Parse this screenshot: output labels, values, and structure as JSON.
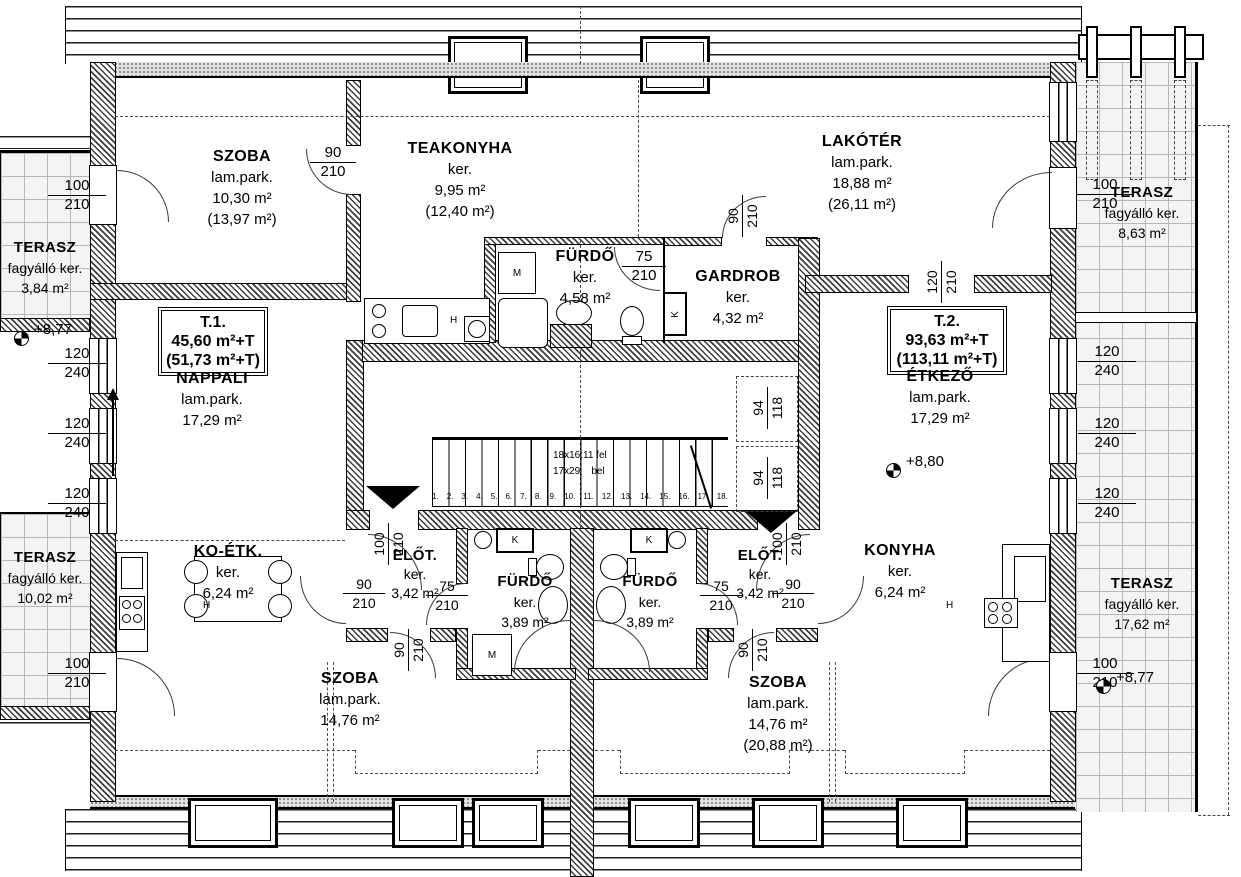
{
  "apartments": {
    "t1": {
      "id": "T.1.",
      "line2": "45,60 m²+T",
      "line3": "(51,73 m²+T)"
    },
    "t2": {
      "id": "T.2.",
      "line2": "93,63 m²+T",
      "line3": "(113,11 m²+T)"
    }
  },
  "rooms": {
    "szoba_tl": {
      "name": "SZOBA",
      "finish": "lam.park.",
      "area": "10,30 m²",
      "area2": "(13,97 m²)"
    },
    "teakonyha": {
      "name": "TEAKONYHA",
      "finish": "ker.",
      "area": "9,95 m²",
      "area2": "(12,40 m²)"
    },
    "lakoter": {
      "name": "LAKÓTÉR",
      "finish": "lam.park.",
      "area": "18,88 m²",
      "area2": "(26,11 m²)"
    },
    "furdo_top": {
      "name": "FÜRDŐ",
      "finish": "ker.",
      "area": "4,58 m²"
    },
    "gardrob": {
      "name": "GARDROB",
      "finish": "ker.",
      "area": "4,32 m²"
    },
    "nappali": {
      "name": "NAPPALI",
      "finish": "lam.park.",
      "area": "17,29 m²"
    },
    "etkezo": {
      "name": "ÉTKEZŐ",
      "finish": "lam.park.",
      "area": "17,29 m²"
    },
    "ko_etk": {
      "name": "KO-ÉTK.",
      "finish": "ker.",
      "area": "6,24 m²"
    },
    "konyha": {
      "name": "KONYHA",
      "finish": "ker.",
      "area": "6,24 m²"
    },
    "elot_l": {
      "name": "ELŐT.",
      "finish": "ker.",
      "area": "3,42 m²"
    },
    "elot_r": {
      "name": "ELŐT.",
      "finish": "ker.",
      "area": "3,42 m²"
    },
    "furdo_bl": {
      "name": "FÜRDŐ",
      "finish": "ker.",
      "area": "3,89 m²"
    },
    "furdo_br": {
      "name": "FÜRDŐ",
      "finish": "ker.",
      "area": "3,89 m²"
    },
    "szoba_bl": {
      "name": "SZOBA",
      "finish": "lam.park.",
      "area": "14,76 m²"
    },
    "szoba_br": {
      "name": "SZOBA",
      "finish": "lam.park.",
      "area": "14,76 m²",
      "area2": "(20,88 m²)"
    },
    "terasz_tl": {
      "name": "TERASZ",
      "finish": "fagyálló ker.",
      "area": "3,84 m²"
    },
    "terasz_bl": {
      "name": "TERASZ",
      "finish": "fagyálló ker.",
      "area": "10,02 m²"
    },
    "terasz_tr": {
      "name": "TERASZ",
      "finish": "fagyálló ker.",
      "area": "8,63 m²"
    },
    "terasz_br": {
      "name": "TERASZ",
      "finish": "fagyálló ker.",
      "area": "17,62 m²"
    }
  },
  "dims": {
    "d90_210": [
      "90",
      "210"
    ],
    "d75_210": [
      "75",
      "210"
    ],
    "d100_210": [
      "100",
      "210"
    ],
    "d120_240": [
      "120",
      "240"
    ],
    "d120_210": [
      "120",
      "210"
    ],
    "d94_118": [
      "94",
      "118"
    ]
  },
  "levels": {
    "terasz_left": "+8,77",
    "etkezo": "+8,80",
    "terasz_right": "+8,77"
  },
  "stairs": {
    "note_up": "18x16:11 fel",
    "note_tread": "17x29",
    "note_dir": "bel",
    "steps": [
      "1.",
      "2.",
      "3.",
      "4.",
      "5.",
      "6.",
      "7.",
      "8.",
      "9.",
      "10.",
      "11.",
      "12.",
      "13.",
      "14.",
      "15.",
      "16.",
      "17.",
      "18."
    ]
  },
  "letters": {
    "washing_machine": "M",
    "chimney": "K",
    "fridge": "H"
  }
}
